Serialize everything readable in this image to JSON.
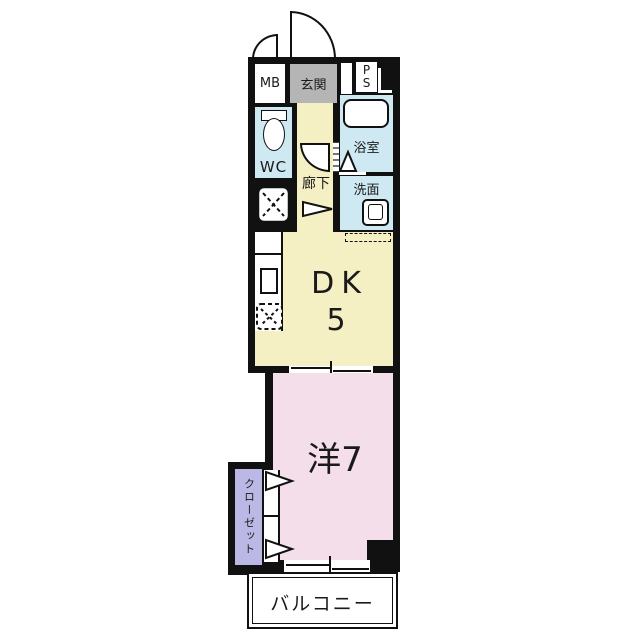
{
  "plan": {
    "mb_label": "MB",
    "entrance_label": "玄関",
    "ps_p": "P",
    "ps_s": "S",
    "wc_label": "WC",
    "bath_label": "浴室",
    "washroom_label": "洗面",
    "hallway_label": "廊下",
    "dk_label": "DK",
    "dk_size": "5",
    "western_room_label": "洋7",
    "closet_label": "クローゼット",
    "balcony_label": "バルコニー"
  },
  "colors": {
    "wall": "#111111",
    "dk_hallway_yellow": "#f5f0c3",
    "western_room_pink": "#f4dee9",
    "wet_area_blue": "#cfe9f2",
    "entrance_gray": "#b5b5b5",
    "closet_purple": "#bcb8e5"
  }
}
